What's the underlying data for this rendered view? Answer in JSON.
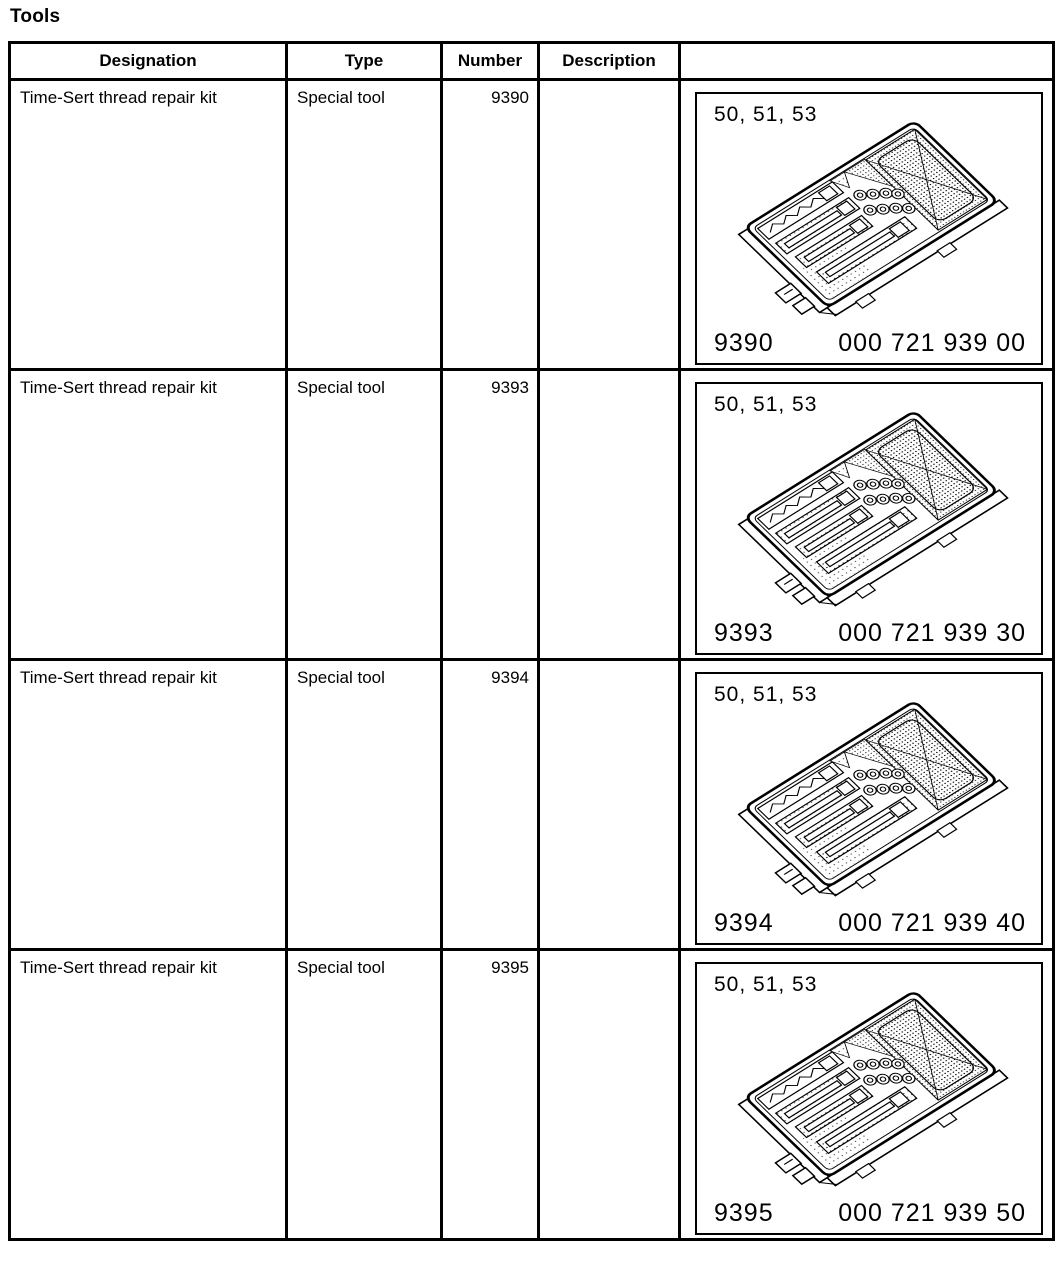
{
  "page": {
    "title": "Tools"
  },
  "colors": {
    "border": "#000000",
    "background": "#ffffff",
    "text": "#000000"
  },
  "table": {
    "headers": [
      "Designation",
      "Type",
      "Number",
      "Description",
      ""
    ],
    "rows": [
      {
        "designation": "Time-Sert thread repair kit",
        "type": "Special tool",
        "number": "9390",
        "description": "",
        "figure": {
          "caption": "50, 51, 53",
          "tool_number": "9390",
          "part_number": "000 721 939 00"
        }
      },
      {
        "designation": "Time-Sert thread repair kit",
        "type": "Special tool",
        "number": "9393",
        "description": "",
        "figure": {
          "caption": "50, 51, 53",
          "tool_number": "9393",
          "part_number": "000 721 939 30"
        }
      },
      {
        "designation": "Time-Sert thread repair kit",
        "type": "Special tool",
        "number": "9394",
        "description": "",
        "figure": {
          "caption": "50, 51, 53",
          "tool_number": "9394",
          "part_number": "000 721 939 40"
        }
      },
      {
        "designation": "Time-Sert thread repair kit",
        "type": "Special tool",
        "number": "9395",
        "description": "",
        "figure": {
          "caption": "50, 51, 53",
          "tool_number": "9395",
          "part_number": "000 721 939 50"
        }
      }
    ]
  }
}
